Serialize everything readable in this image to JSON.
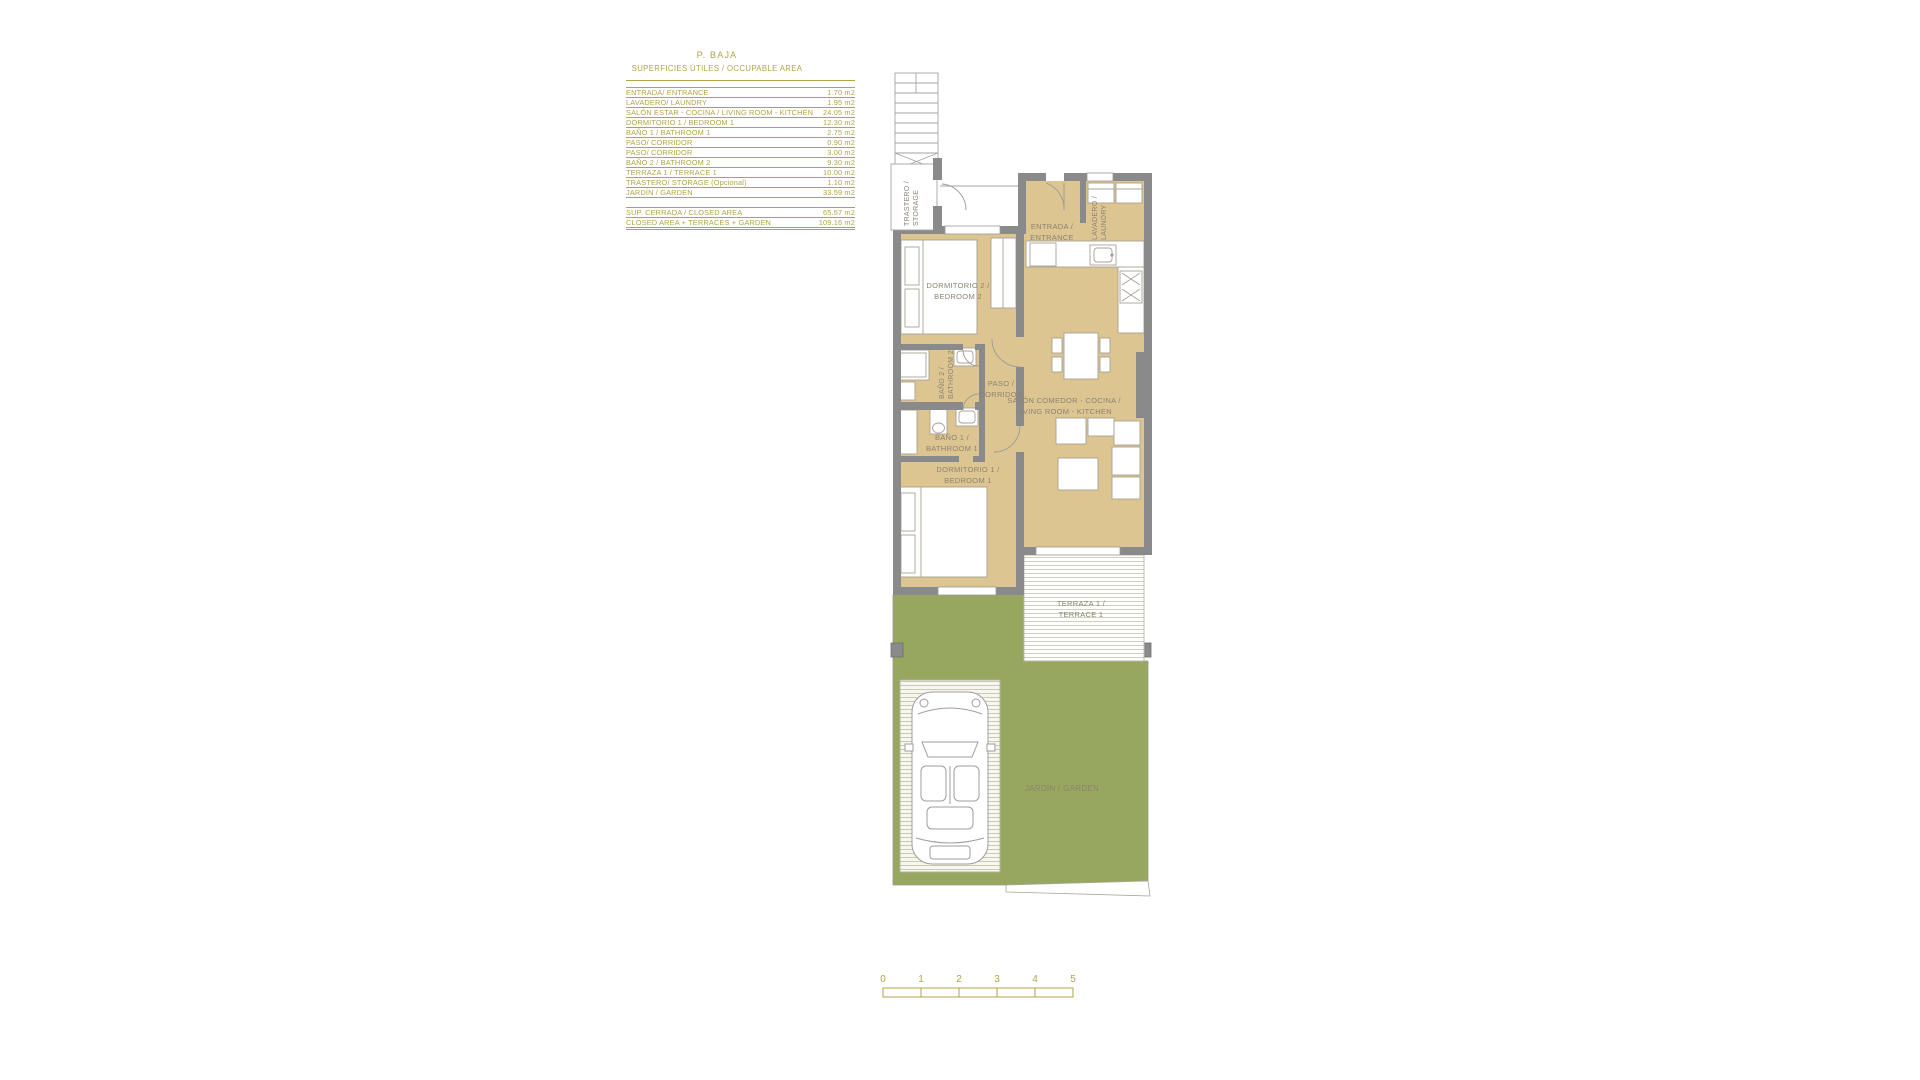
{
  "colors": {
    "accent_olive": "#b0a44a",
    "wall_gray": "#8a8a8a",
    "floor_tan": "#dcc591",
    "garden_green": "#97a75f",
    "plan_label_gray": "#8c8372"
  },
  "area_table": {
    "title": "P. BAJA",
    "subtitle": "SUPERFICIES ÚTILES / OCCUPABLE  AREA",
    "rows": [
      {
        "label": "ENTRADA/ ENTRANCE",
        "value": "1.70 m2"
      },
      {
        "label": "LAVADERO/ LAUNDRY",
        "value": "1.95 m2"
      },
      {
        "label": "SALÓN ESTAR - COCINA  / LIVING ROOM - KITCHEN",
        "value": "24.05 m2"
      },
      {
        "label": "DORMITORIO 1 /  BEDROOM 1",
        "value": "12.30 m2"
      },
      {
        "label": "BAÑO 1 / BATHROOM 1",
        "value": "2.75 m2"
      },
      {
        "label": "PASO/ CORRIDOR",
        "value": "0.90 m2"
      },
      {
        "label": "PASO/ CORRIDOR",
        "value": "3.00 m2"
      },
      {
        "label": "BAÑO 2 / BATHROOM 2",
        "value": "9.30 m2"
      },
      {
        "label": "TERRAZA 1 / TERRACE 1",
        "value": "10.00 m2"
      },
      {
        "label": "TRASTERO/ STORAGE (Opcional)",
        "value": "1.10 m2"
      },
      {
        "label": "JARDÍN / GARDEN",
        "value": "33.59 m2"
      }
    ],
    "summary_rows": [
      {
        "label": "SUP. CERRADA / CLOSED AREA",
        "value": "65.57 m2"
      },
      {
        "label": "CLOSED AREA + TERRACES + GARDEN",
        "value": "109.16 m2"
      }
    ]
  },
  "plan": {
    "rooms": {
      "storage": {
        "line1": "TRASTERO /",
        "line2": "STORAGE"
      },
      "entrance": {
        "line1": "ENTRADA /",
        "line2": "ENTRANCE"
      },
      "laundry": {
        "line1": "LAVADERO /",
        "line2": "LAUNDRY"
      },
      "bedroom2": {
        "line1": "DORMITORIO 2 /",
        "line2": "BEDROOM 2"
      },
      "bathroom2": {
        "line1": "BAÑO 2 /",
        "line2": "BATHROOM 2"
      },
      "corridor": {
        "line1": "PASO /",
        "line2": "CORRIDOR"
      },
      "living": {
        "line1": "SALÓN COMEDOR - COCINA /",
        "line2": "LIVING ROOM - KITCHEN"
      },
      "bathroom1": {
        "line1": "BAÑO 1 /",
        "line2": "BATHROOM 1"
      },
      "bedroom1": {
        "line1": "DORMITORIO 1 /",
        "line2": "BEDROOM 1"
      },
      "terrace": {
        "line1": "TERRAZA 1 /",
        "line2": "TERRACE 1"
      },
      "garden": {
        "label": "JARDÍN / GARDEN"
      }
    },
    "scale_bar": {
      "labels": [
        "0",
        "1",
        "2",
        "3",
        "4",
        "5"
      ]
    }
  }
}
